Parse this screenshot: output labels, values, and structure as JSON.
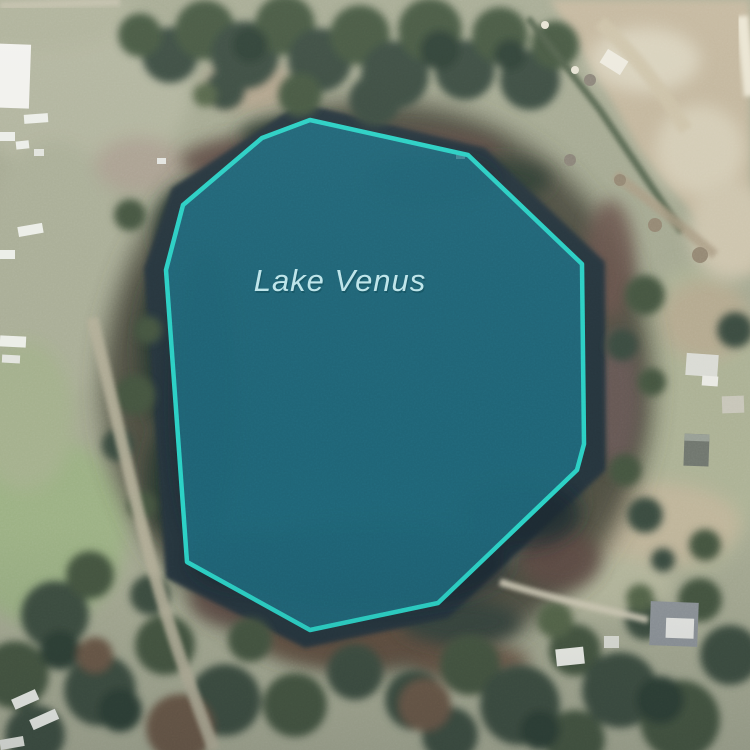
{
  "map": {
    "label": {
      "text": "Lake Venus",
      "color": "#bfe7ec",
      "shadow_color": "#0d4a56"
    },
    "overlay": {
      "feature_name": "Lake Venus",
      "points": "310,120 468,155 582,264 584,444 577,470 438,603 310,630 187,562 166,270 183,205 262,138",
      "stroke_color": "#2bd1c5",
      "fill_color": "#1e6f82",
      "fill_opacity": "0.82"
    }
  }
}
